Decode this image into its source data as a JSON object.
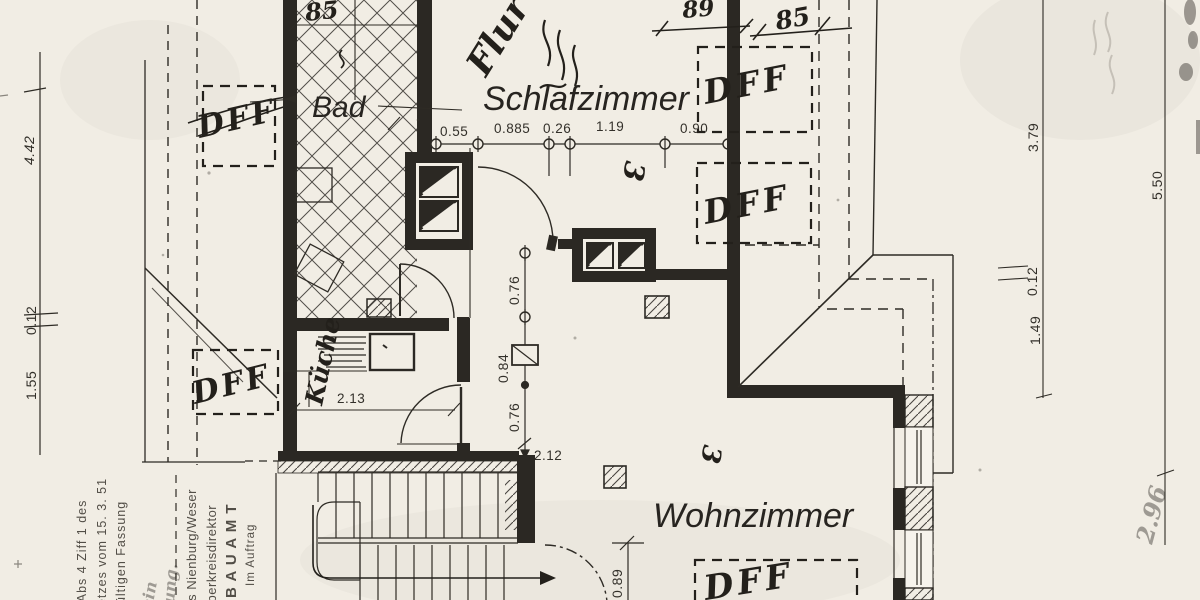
{
  "rooms": {
    "bad": "Bad",
    "schlafzimmer": "Schlafzimmer",
    "wohnzimmer": "Wohnzimmer",
    "kueche": "Küche",
    "flur": "Flur"
  },
  "skylight_label": "DFF",
  "handwritten_dims": {
    "bad_width": "85",
    "top_right_a": "89",
    "top_right_b": "85",
    "room_mark_schlafzimmer": "3",
    "room_mark_wohnzimmer": "3",
    "faint_bottom_right": "2.96"
  },
  "dim_top_chain": [
    "0.55",
    "0.885",
    "0.26",
    "1.19",
    "0.90"
  ],
  "dim_left_chain": [
    "4.42",
    "0.12",
    "1.55"
  ],
  "dim_right_inner": [
    "3.79",
    "0.12",
    "1.49"
  ],
  "dim_right_outer": "5.50",
  "dim_kitchen": "2.13",
  "dim_center_chain": [
    "0.76",
    "0.84",
    "0.76",
    "2.12"
  ],
  "dim_stair_door": "0.89",
  "stamp": {
    "law1": "7 Abs 4 Ziff 1 des",
    "law2": "netzes vom 15. 3. 51",
    "law3": "nültigen Fassung",
    "note1": "ein",
    "note2": "ung.",
    "authority1": "eis Nienburg/Weser",
    "authority2": "r Oberkreisdirektor",
    "authority3": "B A U A M T",
    "authority4": "Im Auftrag"
  },
  "colors": {
    "paper": "#f1ede4",
    "ink": "#2b2823"
  }
}
